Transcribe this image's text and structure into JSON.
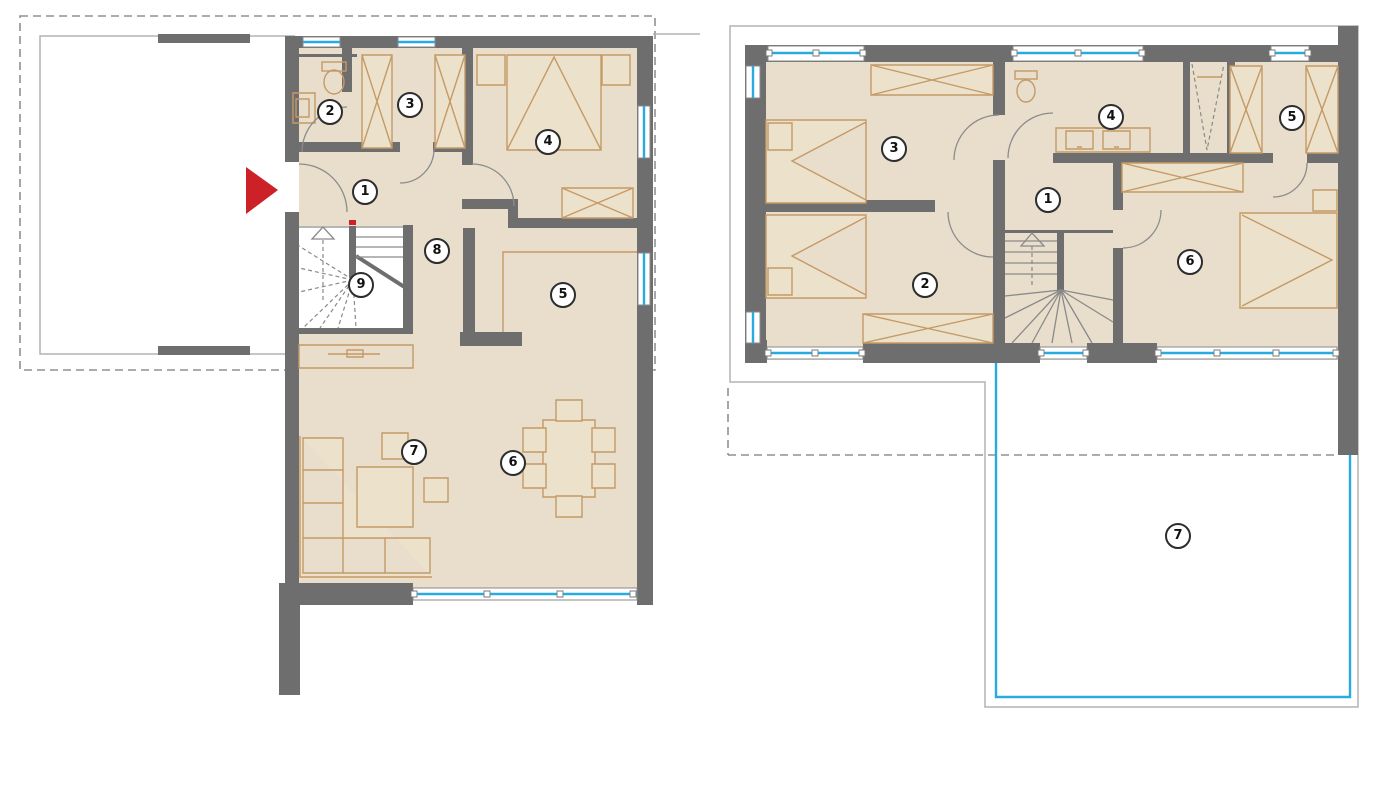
{
  "ground_floor": {
    "rooms": [
      {
        "num": "1"
      },
      {
        "num": "2"
      },
      {
        "num": "3"
      },
      {
        "num": "4"
      },
      {
        "num": "5"
      },
      {
        "num": "6"
      },
      {
        "num": "7"
      },
      {
        "num": "8"
      },
      {
        "num": "9"
      }
    ]
  },
  "upper_floor": {
    "rooms": [
      {
        "num": "1"
      },
      {
        "num": "2"
      },
      {
        "num": "3"
      },
      {
        "num": "4"
      },
      {
        "num": "5"
      },
      {
        "num": "6"
      },
      {
        "num": "7"
      }
    ]
  },
  "colors": {
    "wall": "#6e6e6e",
    "floor": "#e8decb",
    "furniture": "#c49a66",
    "furniture_fill": "#ece1cb",
    "window_blue": "#29abe2",
    "railing_blue": "#29abe2",
    "entrance_red": "#cc2127",
    "outline_gray": "#b3b3b3",
    "dashed_gray": "#909090",
    "door_arc": "#8c8c8c",
    "stair_line": "#8a8a8a",
    "label_border": "#2d2d2d",
    "label_text": "#111111"
  }
}
